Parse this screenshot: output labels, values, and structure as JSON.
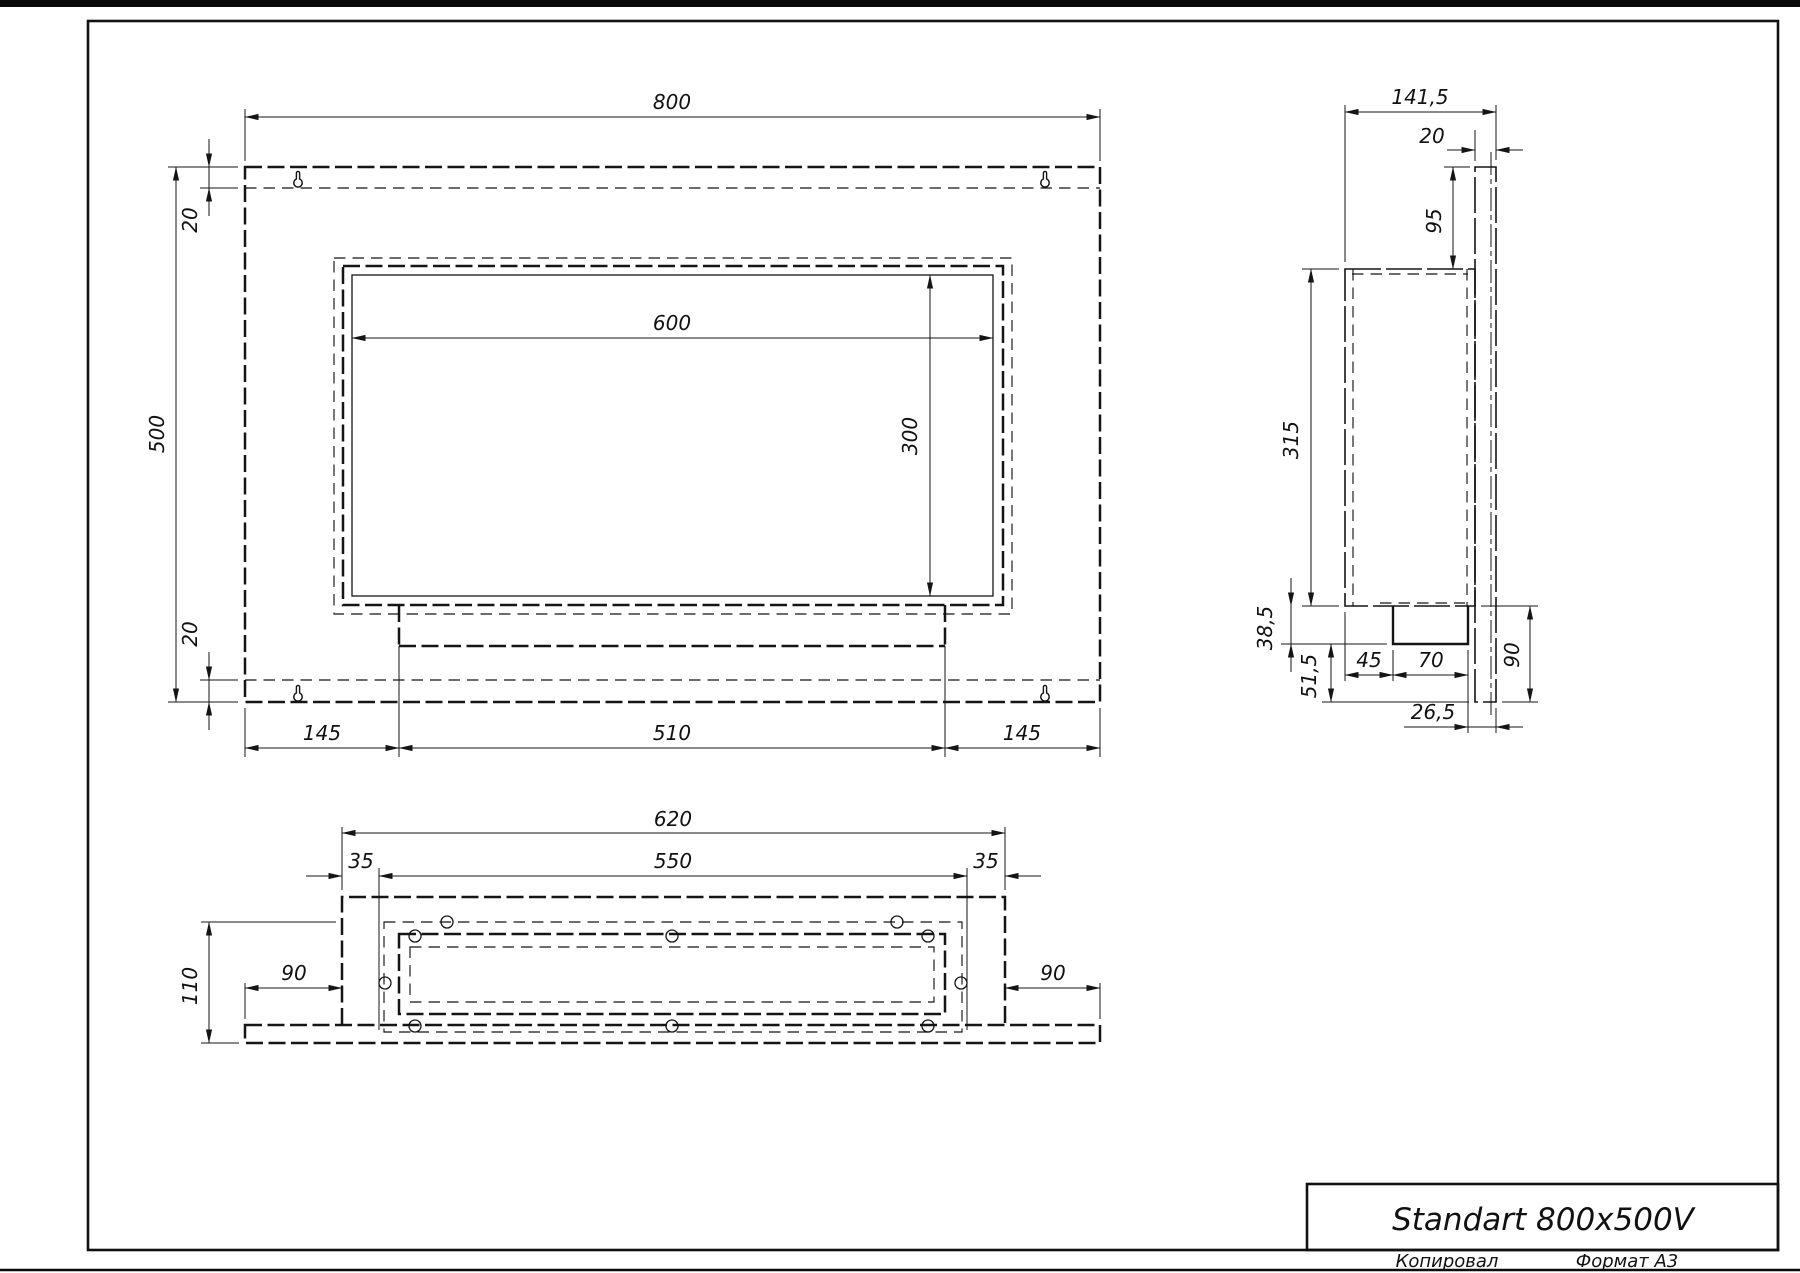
{
  "title_block": {
    "model": "Standart 800x500V",
    "copied": "Копировал",
    "format": "Формат А3"
  },
  "front_view": {
    "width": "800",
    "height": "500",
    "top_inset": "20",
    "bottom_inset": "20",
    "opening_width": "600",
    "opening_height": "300",
    "left_to_tray": "145",
    "tray_width": "510",
    "tray_to_right": "145"
  },
  "side_view": {
    "total_depth": "141,5",
    "plate_thickness": "20",
    "top_to_body": "95",
    "body_height": "315",
    "tray_drop": "38,5",
    "lower_gap": "51,5",
    "burner_offset": "45",
    "burner_width": "70",
    "burner_to_plate": "26,5",
    "plate_below_body": "90"
  },
  "bottom_view": {
    "body_width": "620",
    "inner_width": "550",
    "inset_left": "35",
    "inset_right": "35",
    "depth": "110",
    "wing_left": "90",
    "wing_right": "90"
  }
}
